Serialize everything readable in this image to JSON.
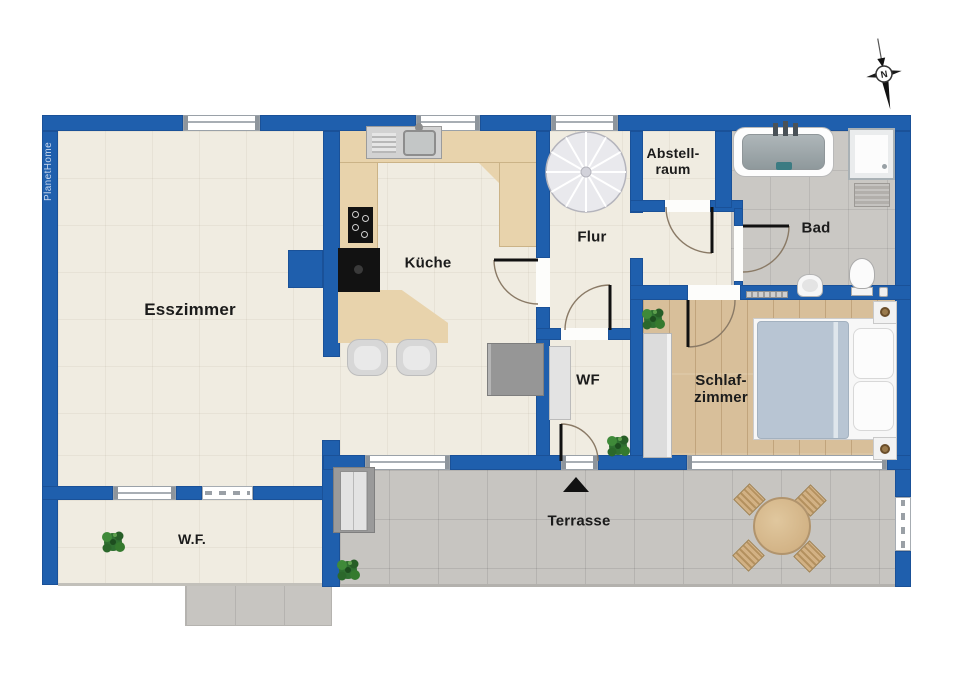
{
  "branding": {
    "watermark": "PlanetHome"
  },
  "compass": {
    "north_label": "N"
  },
  "rooms": {
    "esszimmer": "Esszimmer",
    "kueche": "Küche",
    "flur": "Flur",
    "abstellraum": "Abstell-\nraum",
    "bad": "Bad",
    "wf": "WF",
    "schlafzimmer": "Schlaf-\nzimmer",
    "wf_area": "W.F.",
    "terrasse": "Terrasse"
  },
  "colors": {
    "wall": "#1f5fad",
    "floor": "#f0ece1",
    "wood": "#d8bf9a",
    "counter": "#e8d3ac",
    "terrace": "#c7c5c1",
    "bath": "#cac8c4",
    "duvet": "#b8c5d3",
    "plant": "#2f7031",
    "stair": "#e9e9ed",
    "sideboard": "#969696"
  }
}
